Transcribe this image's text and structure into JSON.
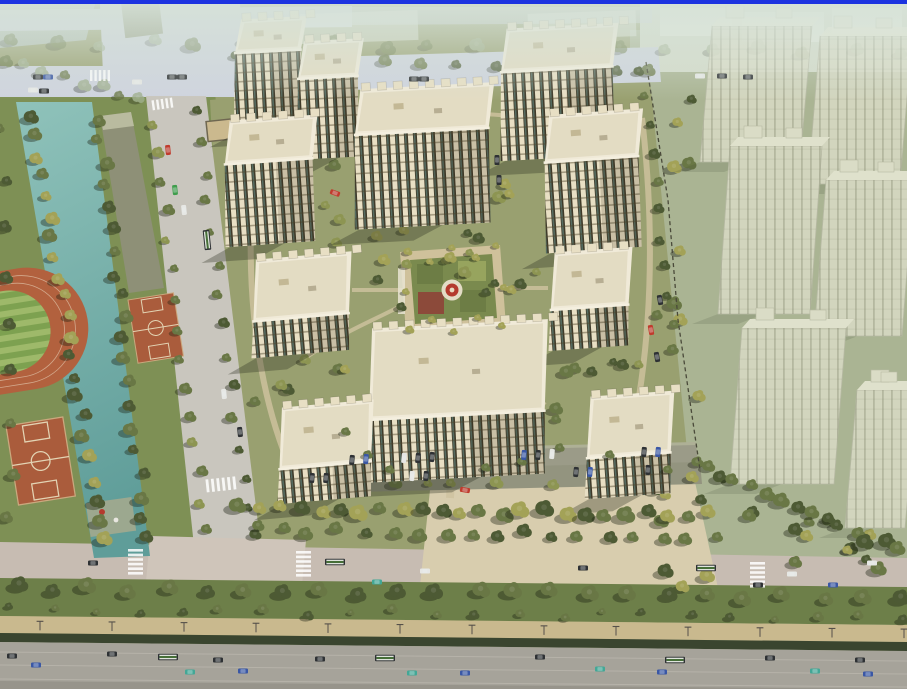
{
  "scene": {
    "description": "Aerial architectural rendering of a high-rise residential compound: cream towers with dark window strips surround a formal central garden with a red circular pavilion; a teal canal, running track and basketball courts lie to the west, translucent future-phase towers to the east, and a wide multi-lane avenue with buses runs along the south edge.",
    "counts": {
      "detailed_towers": 11,
      "ghost_towers": 6,
      "basketball_courts": 2,
      "gardens": 2
    }
  },
  "palette": {
    "blueBar": "#1c33e0",
    "mistTint": "#d6e2d8",
    "parkGreen": "#7e9055",
    "baseOlive": "#99a070",
    "rightBase": "#aab493",
    "plotsPale": "#d4dbca",
    "water1": "#8fc2ba",
    "water2": "#5f9d99",
    "roadLight": "#cfd4de",
    "roadPlain": "#c9c6be",
    "roadTan": "#c7bcb2",
    "plaza": "#d8cdae",
    "grassStrip": "#6d7f49",
    "cyclePath": "#c9b98e",
    "hedge": "#3a452f",
    "highway": "#a6a39a",
    "laneLine": "#c2bfb6",
    "trackOrange": "#b2613e",
    "infield1": "#9eb96a",
    "infield2": "#7da150",
    "courtOrange": "#aa5c3c",
    "treeDark": "#4d5a34",
    "treeMid": "#697745",
    "treeLight": "#8d9552",
    "treeYellow": "#a3a257",
    "treePale": "#9fae8d",
    "cream": "#e8dfc4",
    "roofLight": "#f0ead8",
    "roofShade": "#d9cfb2",
    "winDark": "#3f3a29",
    "glassTeal": "#5c7a72",
    "ghostFill": "#dadbc6",
    "ghostLine": "#b9bba6",
    "shadow": "rgba(40,45,28,0.32)",
    "pathBeige": "#cfc3a0",
    "gardenGreen": "#7a8a4e",
    "gardenPath": "#cfc19b",
    "red": "#b43a2e",
    "carDark": "#2e3134",
    "carBlue": "#3a57a5",
    "carTeal": "#43a796",
    "carWhite": "#e6e7e4",
    "carRed": "#c03b2d",
    "carGreen": "#3f9d4c",
    "busGreen": "#466f38",
    "poleDark": "#55504a"
  }
}
